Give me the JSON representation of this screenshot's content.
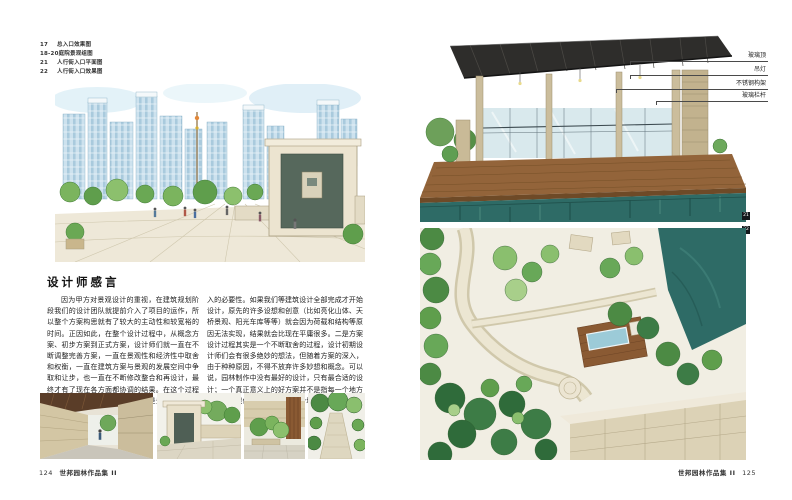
{
  "page_left": {
    "figure_list": [
      {
        "num": "17",
        "label": "总入口效果图"
      },
      {
        "num": "18-20",
        "label": "庭院景观组图"
      },
      {
        "num": "21",
        "label": "人行街入口平面图"
      },
      {
        "num": "22",
        "label": "人行街入口效果图"
      }
    ],
    "section_title": "设计师感言",
    "essay_col1": "因为甲方对景观设计的重视，在建筑规划阶段我们的设计团队就提前介入了项目的运作，所以整个方案构思就有了较大的主动性和较宽裕的时间。正因如此，在整个设计过程中，从概念方案、初步方案到正式方案，设计师们就一直在不断调整完善方案，一直在景观性和经济性中取舍和权衡，一直在建筑方案与景观的发展空间中争取和让步，也一直在不断修改整合和再设计，最终才有了现在各方面都协调的结果。在这个过程中，我们也体会到一些启示，一是景观设计提前介",
    "essay_col2": "入的必要性。如果我们等建筑设计全部完成才开始设计，原先的许多设想和创意（比如亮化山体、天桥景观、阳光车库等等）就会因为荷载和结构等原因无法实现，结果就会比现在平庸很多。二是方案设计过程其实是一个不断取舍的过程，设计初期设计师们会有很多绝妙的想法，但随着方案的深入，由于种种原因，不得不放弃许多妙想和概念。可以说，园林制作中没有最好的设计，只有最合适的设计；一个真正意义上的好方案并不是指每一个地方都设计得很优秀，而是在每一个地方都做了正确的取舍。",
    "footer": {
      "page_num": "124",
      "book_title": "世邦园林作品集 II"
    }
  },
  "page_right": {
    "callouts": [
      {
        "label": "玻璃顶"
      },
      {
        "label": "吊灯"
      },
      {
        "label": "不锈钢构架"
      },
      {
        "label": "玻璃栏杆"
      }
    ],
    "badge_top_image": "21",
    "badge_plan_image": "22",
    "footer": {
      "book_title": "世邦园林作品集 II",
      "page_num": "125"
    }
  },
  "colors": {
    "water_teal": "#2e6b66",
    "deck_wood": "#93643a",
    "stone_beige": "#cbbd9c",
    "tree_green": "#5f9e4c",
    "tower_blue": "#cde2ee",
    "pergola_dark": "#2e2d2b"
  }
}
